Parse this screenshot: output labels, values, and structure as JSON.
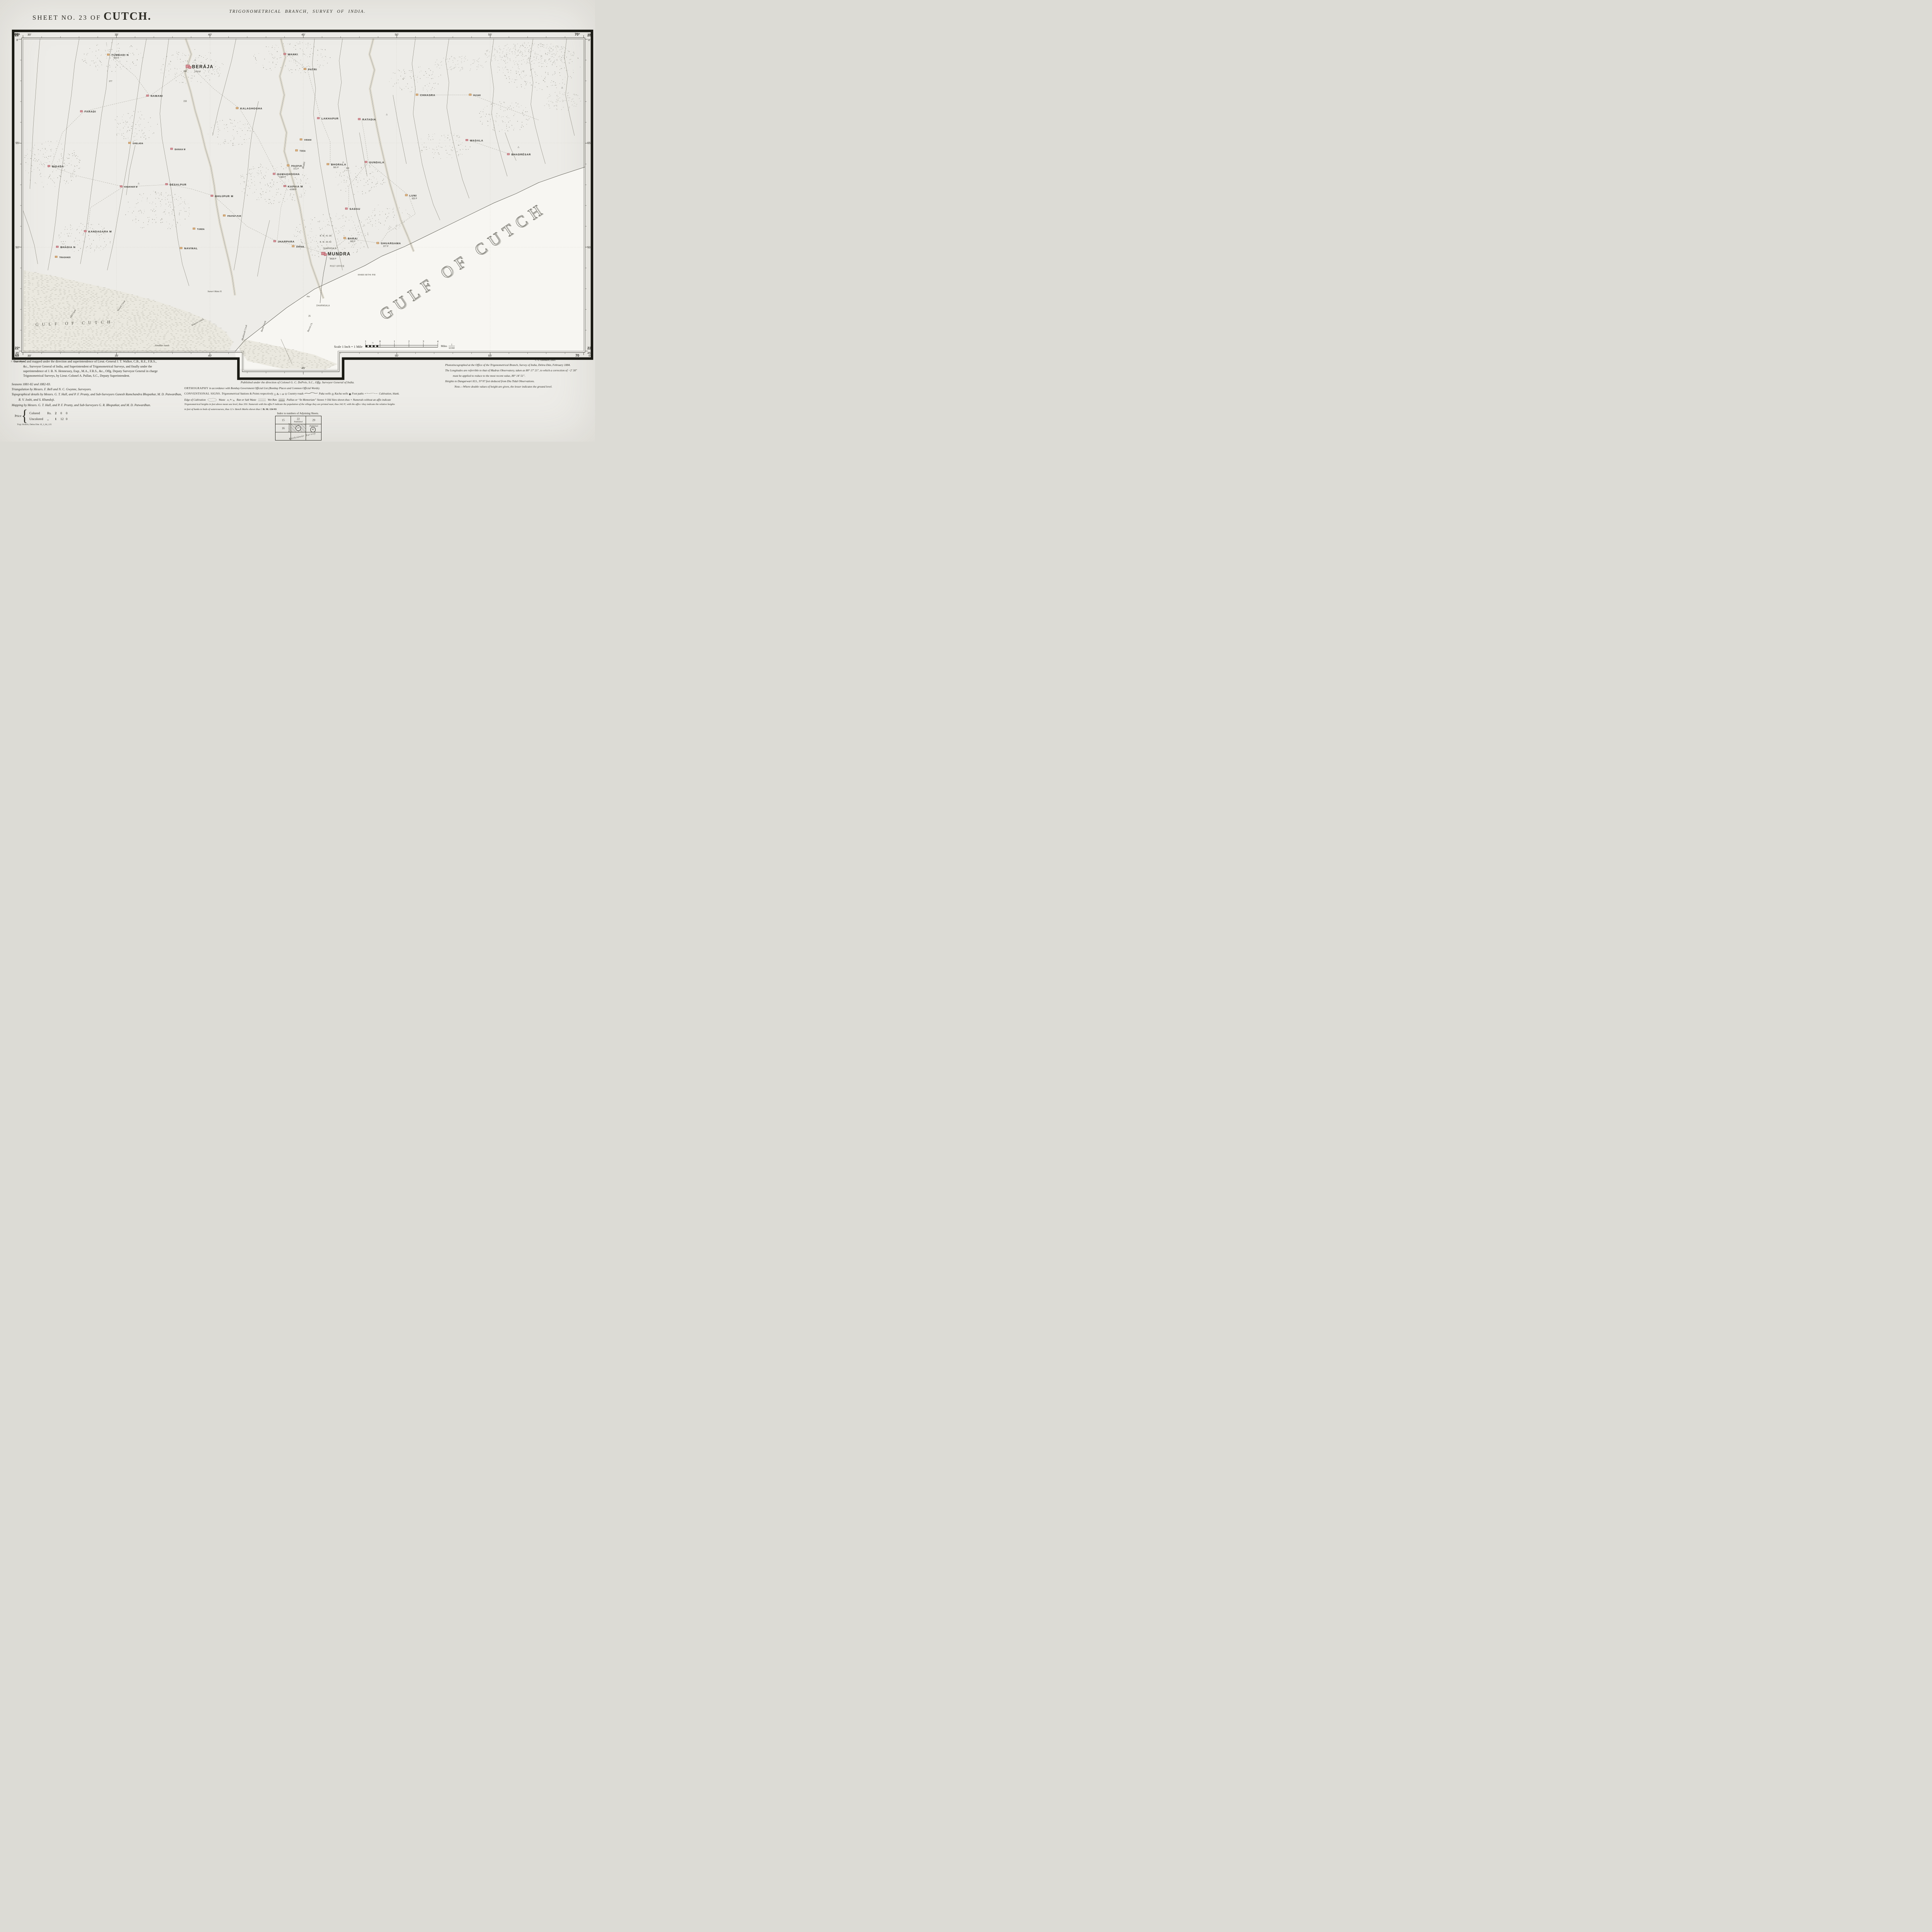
{
  "header": {
    "sheet_no": "SHEET  NO.  23  OF",
    "region": "CUTCH.",
    "branch": "TRIGONOMETRICAL  BRANCH,  SURVEY  OF  INDIA.",
    "photo_credit": "J. Dyson, Photo.",
    "zinco_credit": "C. G. Ollenbach, Zinco."
  },
  "graticule": {
    "top": [
      {
        "deg": "69°",
        "min": "30′",
        "f": 0
      },
      {
        "min": "35′",
        "f": 0.1667
      },
      {
        "min": "40′",
        "f": 0.3333
      },
      {
        "min": "45′",
        "f": 0.5
      },
      {
        "min": "50′",
        "f": 0.6667
      },
      {
        "min": "55′",
        "f": 0.8333
      },
      {
        "deg": "70°",
        "min": "0′",
        "f": 1
      }
    ],
    "bottom": [
      {
        "deg": "69",
        "min": "30′",
        "f": 0
      },
      {
        "min": "35′",
        "f": 0.1667
      },
      {
        "min": "40′",
        "f": 0.3333
      },
      {
        "min": "45′",
        "f": 0.5,
        "notch": true
      },
      {
        "min": "50′",
        "f": 0.6667
      },
      {
        "min": "55′",
        "f": 0.8333
      },
      {
        "deg": "70",
        "min": "0′",
        "f": 1
      }
    ],
    "left": [
      {
        "deg": "23°",
        "min": "0′",
        "f": 0
      },
      {
        "min": "55′",
        "f": 0.3333
      },
      {
        "min": "50′",
        "f": 0.6667
      },
      {
        "deg": "22°",
        "min": "45′",
        "f": 1
      }
    ],
    "right": [
      {
        "deg": "23",
        "min": "0′",
        "f": 0
      },
      {
        "min": "55′",
        "f": 0.3333
      },
      {
        "min": "50′",
        "f": 0.6667
      },
      {
        "deg": "22",
        "min": "45′",
        "f": 1
      }
    ]
  },
  "map": {
    "sea_label_big": {
      "t": "GULF  OF  CUTCH",
      "x": 79,
      "y": 72.5,
      "rot": -34
    },
    "sea_label_small": {
      "t": "GULF  OF  CUTCH",
      "x": 2.2,
      "y": 91.8,
      "rot": -2
    },
    "villages": [
      {
        "n": "TUMBADI N",
        "s": "655 P",
        "x": 15.6,
        "y": 5.2,
        "c": "t",
        "z": "n"
      },
      {
        "n": "BERÁJA",
        "s": "1752 P",
        "x": 30.0,
        "y": 9.0,
        "c": "r",
        "z": "b"
      },
      {
        "n": "WANKI",
        "s": "",
        "x": 47.1,
        "y": 5.0,
        "c": "r",
        "z": "n"
      },
      {
        "n": "PATRI",
        "s": "",
        "x": 50.7,
        "y": 9.8,
        "c": "t",
        "z": "n"
      },
      {
        "n": "NAMANI",
        "s": "",
        "x": 22.6,
        "y": 18.3,
        "c": "r",
        "z": "n"
      },
      {
        "n": "KALAGHOGHA",
        "s": "",
        "x": 38.6,
        "y": 22.3,
        "c": "t",
        "z": "n"
      },
      {
        "n": "FARADI",
        "s": "",
        "x": 10.8,
        "y": 23.3,
        "c": "r",
        "z": "n"
      },
      {
        "n": "LAKHAPUR",
        "s": "",
        "x": 53.1,
        "y": 25.5,
        "c": "r",
        "z": "n"
      },
      {
        "n": "RATADIA",
        "s": "",
        "x": 60.4,
        "y": 25.8,
        "c": "r",
        "z": "n"
      },
      {
        "n": "CHHASRA",
        "s": "",
        "x": 70.7,
        "y": 18.0,
        "c": "t",
        "z": "n"
      },
      {
        "n": "RUVAR",
        "s": "",
        "x": 80.2,
        "y": 18.0,
        "c": "t",
        "z": "s"
      },
      {
        "n": "WADALA",
        "s": "",
        "x": 79.6,
        "y": 32.5,
        "c": "r",
        "z": "n"
      },
      {
        "n": "BHADRÉSAR",
        "s": "",
        "x": 87.0,
        "y": 37.0,
        "c": "r",
        "z": "n"
      },
      {
        "n": "BIDADA",
        "s": "",
        "x": 5.0,
        "y": 40.8,
        "c": "r",
        "z": "n"
      },
      {
        "n": "GHELADA",
        "s": "",
        "x": 19.4,
        "y": 33.4,
        "c": "t",
        "z": "s"
      },
      {
        "n": "BANAIA M",
        "s": "",
        "x": 26.9,
        "y": 35.3,
        "c": "r",
        "z": "s"
      },
      {
        "n": "KHAKHAR M",
        "s": "",
        "x": 17.9,
        "y": 47.3,
        "c": "r",
        "z": "s"
      },
      {
        "n": "DESALPUR",
        "s": "",
        "x": 26.0,
        "y": 46.6,
        "c": "r",
        "z": "n"
      },
      {
        "n": "BHUJPUR M",
        "s": "",
        "x": 34.1,
        "y": 50.3,
        "c": "r",
        "z": "n"
      },
      {
        "n": "SAMAGHOGHA",
        "s": "1350 P",
        "x": 45.2,
        "y": 43.3,
        "c": "r",
        "z": "n"
      },
      {
        "n": "PRAGPUR",
        "s": "271 P",
        "x": 47.7,
        "y": 40.6,
        "c": "t",
        "z": "s"
      },
      {
        "n": "BHORALA",
        "s": "501 P",
        "x": 54.8,
        "y": 40.2,
        "c": "t",
        "z": "n"
      },
      {
        "n": "KAPAIA M",
        "s": "1098 P",
        "x": 47.1,
        "y": 47.2,
        "c": "r",
        "z": "n"
      },
      {
        "n": "GUNDALA",
        "s": "",
        "x": 61.6,
        "y": 39.5,
        "c": "r",
        "z": "n"
      },
      {
        "n": "VIRANI",
        "s": "",
        "x": 50.0,
        "y": 32.3,
        "c": "t",
        "z": "s"
      },
      {
        "n": "TODA",
        "s": "",
        "x": 49.2,
        "y": 35.8,
        "c": "t",
        "z": "s"
      },
      {
        "n": "PRATAP-PUR",
        "s": "",
        "x": 36.3,
        "y": 56.6,
        "c": "t",
        "z": "s"
      },
      {
        "n": "SADAU",
        "s": "",
        "x": 58.1,
        "y": 54.4,
        "c": "r",
        "z": "n"
      },
      {
        "n": "LUNI",
        "s": "925 P",
        "x": 68.8,
        "y": 50.1,
        "c": "t",
        "z": "n"
      },
      {
        "n": "KANDAGARA M",
        "s": "",
        "x": 11.5,
        "y": 61.6,
        "c": "r",
        "z": "n"
      },
      {
        "n": "BHADIA N",
        "s": "",
        "x": 6.5,
        "y": 66.6,
        "c": "r",
        "z": "n"
      },
      {
        "n": "TRAGHADI",
        "s": "",
        "x": 6.3,
        "y": 69.8,
        "c": "t",
        "z": "s"
      },
      {
        "n": "NAVINAL",
        "s": "",
        "x": 28.6,
        "y": 67.0,
        "c": "t",
        "z": "n"
      },
      {
        "n": "TUNDA",
        "s": "",
        "x": 30.9,
        "y": 60.8,
        "c": "t",
        "z": "s"
      },
      {
        "n": "JHARPARA",
        "s": "",
        "x": 45.3,
        "y": 64.8,
        "c": "r",
        "z": "n"
      },
      {
        "n": "DHRAB",
        "s": "",
        "x": 48.6,
        "y": 66.4,
        "c": "t",
        "z": "s"
      },
      {
        "n": "MUNDRA",
        "s": "8928 P",
        "x": 54.2,
        "y": 68.8,
        "c": "r",
        "z": "b"
      },
      {
        "n": "BARAI",
        "s": "992 P",
        "x": 57.8,
        "y": 63.8,
        "c": "t",
        "z": "n"
      },
      {
        "n": "GHUARSAMA",
        "s": "377 P",
        "x": 63.7,
        "y": 65.4,
        "c": "t",
        "z": "n"
      },
      {
        "n": "KHARI MITHI PIR",
        "s": "",
        "x": 59.6,
        "y": 75.4,
        "c": "n",
        "z": "s"
      },
      {
        "n": "POST OFFICE",
        "s": "",
        "x": 54.6,
        "y": 72.6,
        "c": "n",
        "z": "s"
      },
      {
        "n": "DHARMSALA",
        "s": "",
        "x": 53.4,
        "y": 66.9,
        "c": "n",
        "z": "s"
      },
      {
        "n": "B. M. 41·39",
        "s": "",
        "x": 52.8,
        "y": 62.9,
        "c": "n",
        "z": "s"
      },
      {
        "n": "B. M. 35·43",
        "s": "",
        "x": 52.8,
        "y": 64.9,
        "c": "n",
        "z": "s"
      },
      {
        "n": "DHARMSALA",
        "s": "",
        "x": 52.2,
        "y": 85.2,
        "c": "n",
        "z": "s"
      }
    ],
    "water_labels": [
      {
        "t": "Bhukhi",
        "x": 50.2,
        "y": 40.5,
        "r": -78
      },
      {
        "t": "Old Creek",
        "x": 9.0,
        "y": 88.0,
        "r": -58
      },
      {
        "t": "Nawali Creek",
        "x": 17.6,
        "y": 85.5,
        "r": -55
      },
      {
        "t": "Khariro Creek",
        "x": 31.2,
        "y": 90.8,
        "r": -28
      },
      {
        "t": "Bhukhandi Creek",
        "x": 39.6,
        "y": 94.0,
        "r": -75
      },
      {
        "t": "Bandi Creek",
        "x": 43.0,
        "y": 92.0,
        "r": -70
      },
      {
        "t": "Barchi Ck.",
        "x": 51.3,
        "y": 92.3,
        "r": -65
      },
      {
        "t": "Sunari Mata H.",
        "x": 34.2,
        "y": 81.0,
        "r": 0
      },
      {
        "t": "Sonddari Sands",
        "x": 24.8,
        "y": 98.3,
        "r": 0
      }
    ],
    "spot_heights": [
      {
        "t": "277",
        "x": 15.3,
        "y": 13.8
      },
      {
        "t": "233",
        "x": 28.6,
        "y": 20.2
      },
      {
        "t": "262",
        "x": 28.6,
        "y": 10.6
      },
      {
        "t": "110",
        "x": 57.6,
        "y": 41.6
      },
      {
        "t": "25",
        "x": 50.9,
        "y": 88.8
      },
      {
        "t": "Hut",
        "x": 50.6,
        "y": 82.6,
        "i": 1
      }
    ],
    "trig_stations": [
      {
        "x": 88.4,
        "y": 34.8
      },
      {
        "x": 57.1,
        "y": 39.6
      },
      {
        "x": 30.7,
        "y": 7.0
      },
      {
        "x": 64.9,
        "y": 24.4
      },
      {
        "x": 96.2,
        "y": 15.8
      },
      {
        "x": 20.6,
        "y": 46.4
      }
    ]
  },
  "scale": {
    "label": "Scale 1 Inch = 1 Mile",
    "marks": [
      "1",
      "0",
      "1",
      "2",
      "3",
      "4"
    ],
    "half": "½",
    "miles_label": "Miles",
    "rf_num": "1",
    "rf_den": "63360"
  },
  "credits": {
    "lines": [
      "Surveyed and mapped under the direction and superintendence of Lieut.-General J. T. Walker, C.B., R.E., F.R.S.,",
      "&c., Surveyor General of India, and Superintendent of Trigonometrical Surveys, and finally under the",
      "superintendence of J. B. N. Hennessey, Esqr., M.A., F.R.S., &c., Offg. Deputy Surveyor General in charge",
      "Trigonometrical Surveys, by Lieut.-Colonel A. Pullan, S.C., Deputy Superintendent."
    ],
    "seasons": "Seasons 1881-82 and 1882-83.",
    "triangulation": "Triangulation by Messrs. F. Bell and N. C. Gwynne, Surveyors.",
    "topo1": "Topographical details by Messrs. G. T. Hall, and P. F. Prunty, and Sub-Surveyors Ganesh Ramchandra Bhopatkar, M. D. Patwardhan,",
    "topo2": "R. V. Joshi, and S. Khandoji.",
    "mapping": "Mapping by Messrs. G. T. Hall, and P. F. Prunty, and Sub-Surveyors G. R. Bhopatkar, and M. D. Patwardhan.",
    "price_label": "Price",
    "price_rows": [
      {
        "kind": "Colored",
        "cur": "Rs.",
        "a": "2",
        "b": "0",
        "c": "0"
      },
      {
        "kind": "Uncolored",
        "cur": ",,",
        "a": "1",
        "b": "12",
        "c": "0"
      }
    ],
    "imprint": "Trigl. Branch, Dehra Dún 19_3_84_125"
  },
  "center": {
    "published": "Published under the direction of Colonel G. C. DePrée, S.C., Offg. Surveyor General of India.",
    "orthography_label": "ORTHOGRAPHY",
    "orthography_text": "in accordance with Bombay Government Official List (Bombay Places and Common Official Words).",
    "conv_label": "CONVENTIONAL SIGNS.",
    "t1a": "Trigonometrical Stations & Points respectively",
    "stations_syms": "△ & ○ or ⊙",
    "t1b": "Country roads",
    "t1c": "Paka wells",
    "paka_sym": "◎",
    "t1d": "Kacha wells",
    "kacha_sym": "◉",
    "t1e": "Foot paths",
    "t1f": "Cultivation, blank.",
    "t2a": "Edge of Cultivation",
    "t2b": "Waste",
    "t2c": "Ran or Salt Waste",
    "t2d": "Wet Ran",
    "t2e": "Pallias or “In Memoriam” Stones †",
    "t2f": "Old Sites shewn thus ×",
    "t2g": "Numerals without an affix indicate",
    "t3": "Trigonometrical heights in feet above mean sea level, thus 350.  Numerals with the affix P indicate the population of the village they are printed near, thus 342 P; with the affix r they indicate the relative heights",
    "t4a": "in feet of banks to beds of watercourses, thus 12 r.  Bench Marks shewn thus",
    "bm_sym": "□",
    "t4b": "B. M. 134·93"
  },
  "index": {
    "caption": "Index to numbers of Adjoining Sheets.",
    "r1c1": "15",
    "r1c2": "22",
    "r1c3": "29",
    "r2c1": "16",
    "r2c2": "23",
    "r2c3": "42",
    "published_c2": "Published",
    "published_c3": "Published",
    "published_vert": "Published",
    "diagonal": "Káthiáwár Survey"
  },
  "right": {
    "photozinco": "Photozincographed at the Office of the Trigonometrical Branch, Survey of India, Dehra Dún, February 1884.",
    "long1": "The Longitudes are referrible to that of Madras Observatory, taken as 80° 17′ 21″, to which a correction of −2′ 30″",
    "long2": "must be applied to reduce to the most recent value, 80° 14′ 51″.",
    "heights": "Heights to Dangarwari H.S., 97·97 feet deduced from Diu Tidal Observations.",
    "note": "Note.—Where double values of height are given, the lesser indicates the ground level."
  },
  "colors": {
    "village_red": "#d98f96",
    "village_red_edge": "#8c3a41",
    "village_tan": "#dcaf7a",
    "village_tan_edge": "#97642e",
    "sea": "#f7f6f2",
    "ink": "#26251f",
    "stream": "#6e6c5f",
    "sand": "#cfc4a8"
  }
}
